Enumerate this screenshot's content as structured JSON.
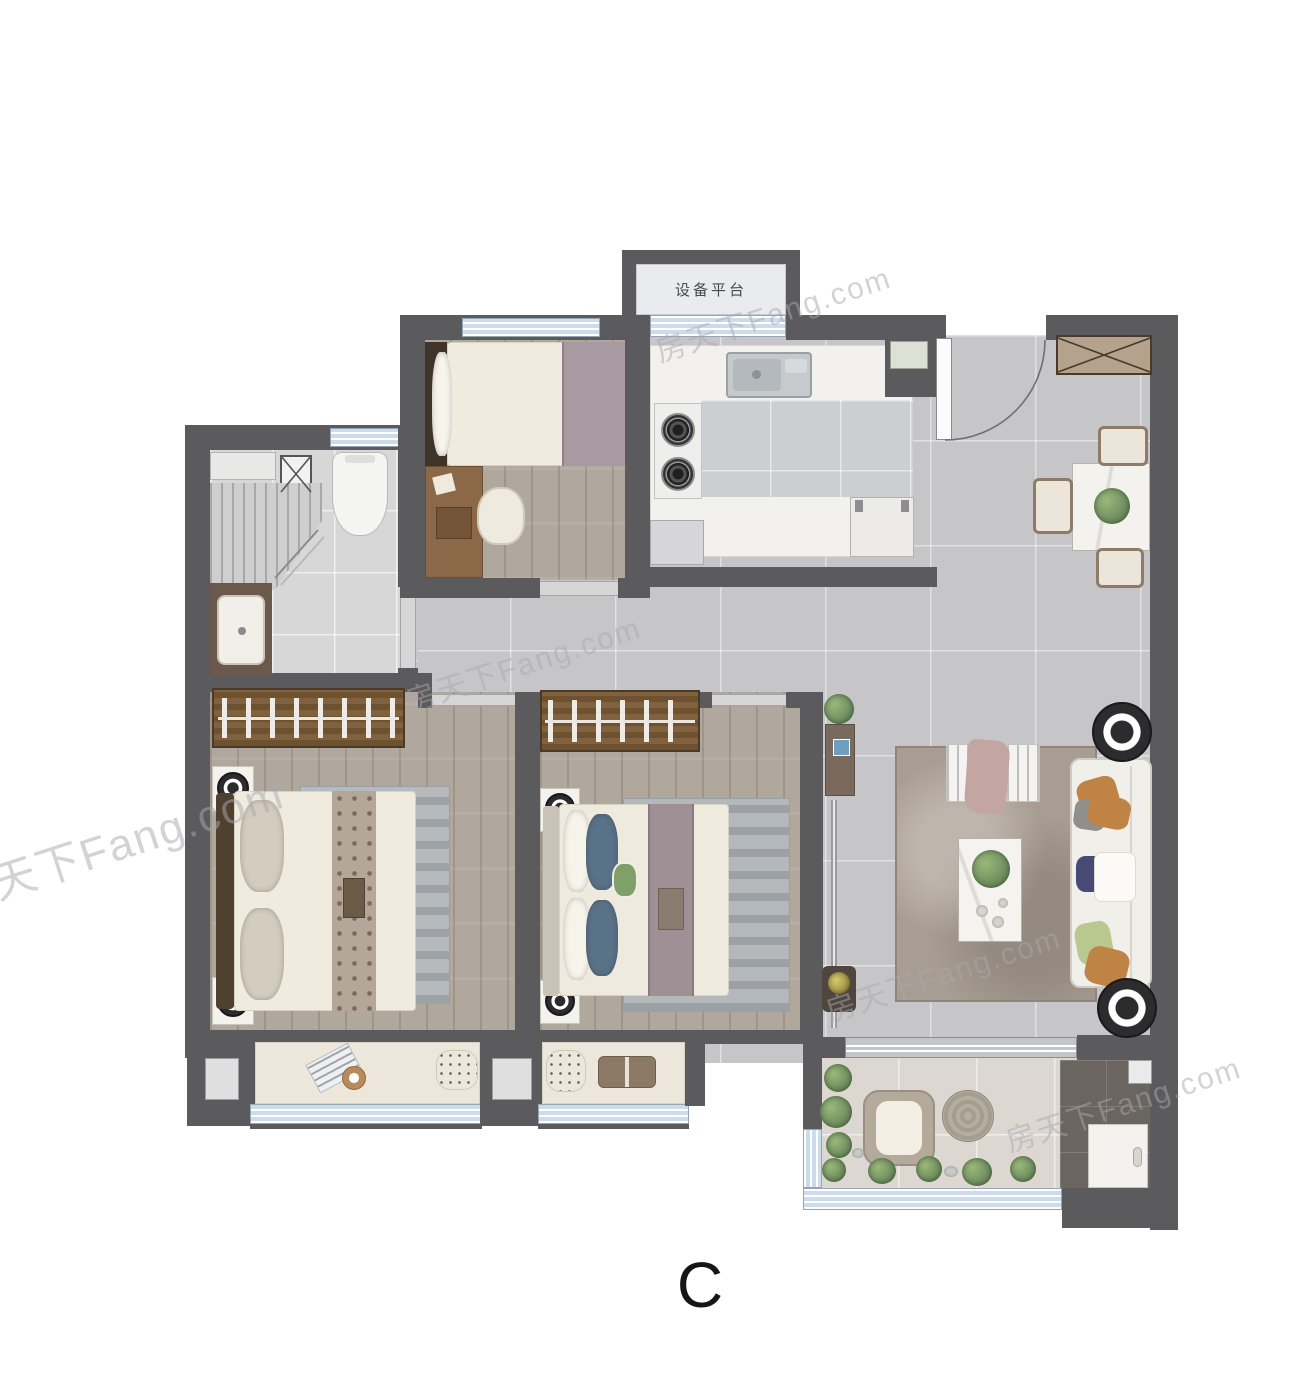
{
  "labels": {
    "equipment_platform": "设备平台",
    "unit": "C",
    "watermark": "房天下Fang.com"
  },
  "colors": {
    "wall": "#5b5b5d",
    "window_fill": "#ccdcec",
    "tile_floor": "#c6c6c8",
    "wood_floor": "#b0a79d",
    "bath_floor": "#d7d7d7",
    "kitchen_floor": "#cdced1",
    "kitchen_counter": "#f2f1ee",
    "balcony_floor": "#dcd8d1",
    "dark_tile": "#6b6560",
    "wardrobe_wood": "#82613f",
    "cabinet_tan": "#b4a28c",
    "rug_living": "#a89d92",
    "rug_bedroom": "#b7babd",
    "sofa_white": "#f1efe9",
    "pillow_orange": "#bf8445",
    "pillow_navy": "#474a74",
    "pillow_green": "#b8c88f",
    "plant_green": "#6f8f5f",
    "lamp_black": "#2c2c2e",
    "seat_cream": "#ece7da",
    "chair_frame": "#8d7c68",
    "steel": "#c6cacd"
  }
}
